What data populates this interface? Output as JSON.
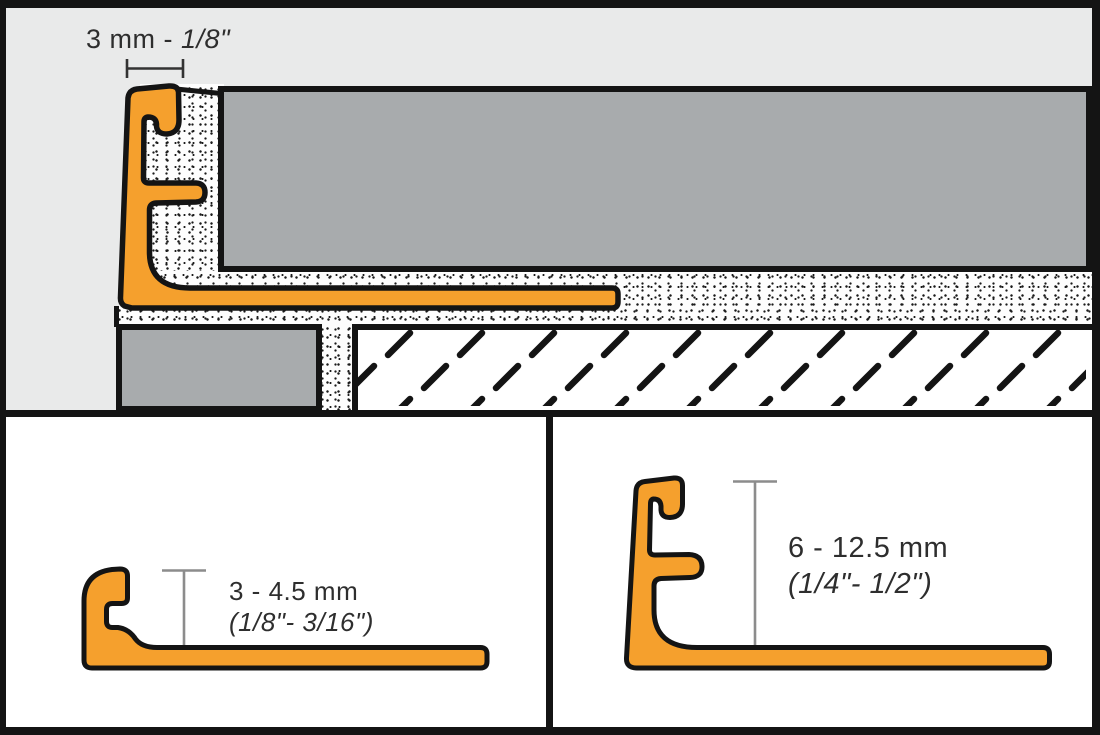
{
  "diagram": {
    "top_panel": {
      "dimension_label": {
        "metric": "3 mm - ",
        "imperial": "1/8\""
      }
    },
    "bottom_left_panel": {
      "height_range_metric": "3 - 4.5 mm",
      "height_range_imperial": "(1/8\"- 3/16\")"
    },
    "bottom_right_panel": {
      "height_range_metric": "6 - 12.5 mm",
      "height_range_imperial": "(1/4\"- 1/2\")"
    }
  },
  "colors": {
    "profile_orange": "#F5A02D",
    "tile_gray": "#A8ABAD",
    "top_background_gray": "#E9EAEA",
    "outline_black": "#141414",
    "dimension_line_gray": "#8C8C8C",
    "panel_white": "#FFFFFF"
  }
}
